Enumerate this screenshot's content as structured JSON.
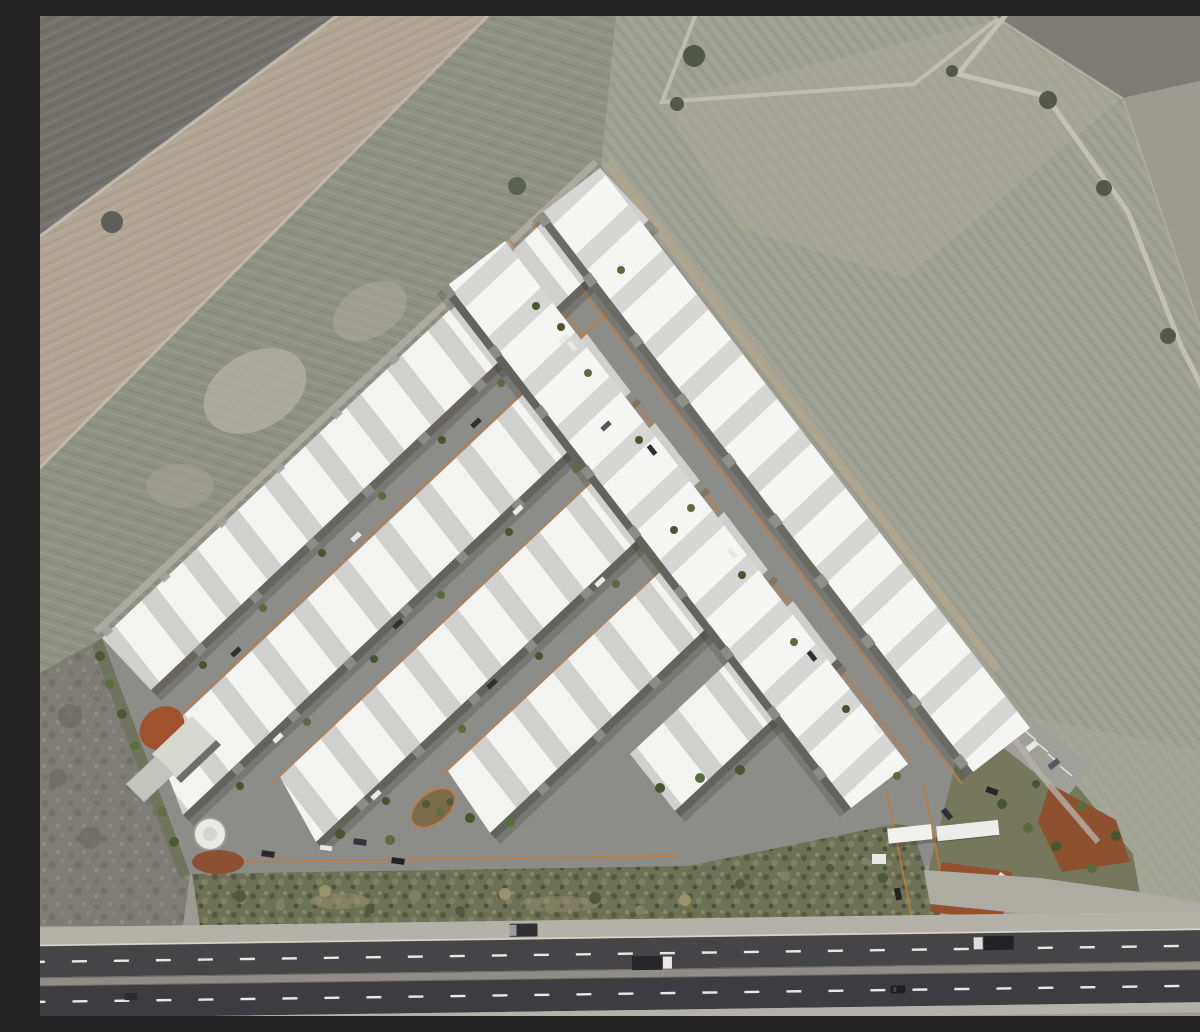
{
  "scene": {
    "description": "Top-down aerial 3D architectural rendering of an industrial warehouse park on a triangular plot surrounded by plowed farmland, with a multi-lane highway running along the bottom edge",
    "type": "aerial-render",
    "time_of_day": "daytime",
    "no_visible_text": true
  },
  "palette": {
    "field_dark": "#72716b",
    "field_tan": "#b1a694",
    "field_scrub": "#8f9184",
    "field_right_green": "#9da092",
    "rough_ground": "#7d7d76",
    "site_asphalt": "#8c8c88",
    "roof_white": "#f3f3f1",
    "roof_shade": "#d0d0ce",
    "facade_gray": "#63635d",
    "curb_orange": "#c27c3c",
    "hedge_green": "#6d7155",
    "planting_soil_red": "#8e5130",
    "highway_asphalt": "#454548",
    "highway_shoulder": "#b4b1a9",
    "lane_marking": "#e8e8e4",
    "tree_green": "#46562f",
    "water_tank_white": "#e9e9e5"
  },
  "site": {
    "plot_shape": "triangular / diamond plot",
    "warehouse_rows": [
      {
        "id": "northwest-edge-row",
        "orientation": "southwest-northeast"
      },
      {
        "id": "interior-row-2",
        "orientation": "southwest-northeast"
      },
      {
        "id": "interior-row-3",
        "orientation": "southwest-northeast"
      },
      {
        "id": "interior-row-4",
        "orientation": "southwest-northeast"
      },
      {
        "id": "interior-row-5",
        "orientation": "southwest-northeast"
      },
      {
        "id": "interior-row-ne-parallel",
        "orientation": "northwest-southeast"
      },
      {
        "id": "northeast-edge-row",
        "orientation": "northwest-southeast"
      }
    ],
    "features": [
      "internal streets with orange curbs",
      "street trees",
      "parked cars",
      "water tank",
      "utility sheds",
      "red-soil planting beds",
      "teardrop traffic island",
      "entrance gate with twin white canopies",
      "guard booth",
      "visitor parking lot",
      "perimeter hedge strip",
      "landscaped east corner"
    ]
  },
  "highway": {
    "carriageways": 2,
    "dashed_lane_lines": 2,
    "median": true,
    "vehicles": [
      {
        "type": "van",
        "color": "dark-gray",
        "position": "left shoulder"
      },
      {
        "type": "truck",
        "color": "dark trailer, white cab",
        "position": "upper carriageway center"
      },
      {
        "type": "truck",
        "color": "dark trailer, white cab",
        "position": "upper carriageway right"
      },
      {
        "type": "car",
        "color": "black",
        "position": "lower carriageway center-right"
      },
      {
        "type": "car",
        "color": "black",
        "position": "lower carriageway far left"
      },
      {
        "type": "truck",
        "color": "yellow",
        "position": "right edge"
      }
    ]
  },
  "farmland": {
    "parcels": [
      "dark plowed field top-left",
      "tan strip field upper-left",
      "gray-green scrub left of site",
      "large furrowed field right of site",
      "dark strip top-right corner",
      "rough scrub lower-left"
    ],
    "details": [
      "dirt tracks between parcels",
      "scattered tree clumps along field paths"
    ]
  },
  "counts": {
    "street_trees_approx": 45,
    "parked_cars_approx": 22,
    "entrance_canopies": 2
  }
}
